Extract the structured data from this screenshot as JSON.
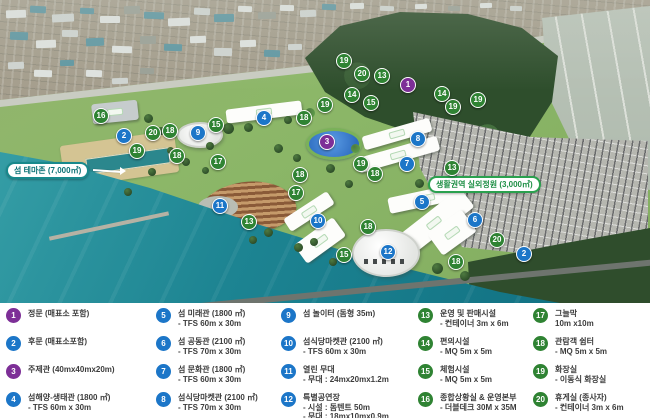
{
  "map": {
    "labels": {
      "theme_zone": "섬 테마존 (7,000㎡)",
      "outdoor_garden": "생활권역 실외정원 (3,000㎡)"
    },
    "marker_colors": {
      "blue": "#1c76c8",
      "green": "#2f8333",
      "purple": "#7d2f97"
    },
    "markers": [
      {
        "n": "16",
        "color": "green",
        "x": 100,
        "y": 115
      },
      {
        "n": "2",
        "color": "blue",
        "x": 123,
        "y": 135
      },
      {
        "n": "20",
        "color": "green",
        "x": 152,
        "y": 132
      },
      {
        "n": "18",
        "color": "green",
        "x": 169,
        "y": 130
      },
      {
        "n": "9",
        "color": "blue",
        "x": 197,
        "y": 132
      },
      {
        "n": "15",
        "color": "green",
        "x": 215,
        "y": 124
      },
      {
        "n": "4",
        "color": "blue",
        "x": 263,
        "y": 117
      },
      {
        "n": "18",
        "color": "green",
        "x": 303,
        "y": 117
      },
      {
        "n": "19",
        "color": "green",
        "x": 324,
        "y": 104
      },
      {
        "n": "19",
        "color": "green",
        "x": 136,
        "y": 150
      },
      {
        "n": "18",
        "color": "green",
        "x": 176,
        "y": 155
      },
      {
        "n": "17",
        "color": "green",
        "x": 217,
        "y": 161
      },
      {
        "n": "18",
        "color": "green",
        "x": 299,
        "y": 174
      },
      {
        "n": "17",
        "color": "green",
        "x": 295,
        "y": 192
      },
      {
        "n": "11",
        "color": "blue",
        "x": 219,
        "y": 205
      },
      {
        "n": "13",
        "color": "green",
        "x": 248,
        "y": 221
      },
      {
        "n": "10",
        "color": "blue",
        "x": 317,
        "y": 220
      },
      {
        "n": "19",
        "color": "green",
        "x": 343,
        "y": 60
      },
      {
        "n": "20",
        "color": "green",
        "x": 361,
        "y": 73
      },
      {
        "n": "13",
        "color": "green",
        "x": 381,
        "y": 75
      },
      {
        "n": "1",
        "color": "purple",
        "x": 407,
        "y": 84
      },
      {
        "n": "14",
        "color": "green",
        "x": 351,
        "y": 94
      },
      {
        "n": "15",
        "color": "green",
        "x": 370,
        "y": 102
      },
      {
        "n": "14",
        "color": "green",
        "x": 441,
        "y": 93
      },
      {
        "n": "19",
        "color": "green",
        "x": 452,
        "y": 106
      },
      {
        "n": "19",
        "color": "green",
        "x": 477,
        "y": 99
      },
      {
        "n": "3",
        "color": "purple",
        "x": 326,
        "y": 141
      },
      {
        "n": "8",
        "color": "blue",
        "x": 417,
        "y": 138
      },
      {
        "n": "7",
        "color": "blue",
        "x": 406,
        "y": 163
      },
      {
        "n": "19",
        "color": "green",
        "x": 360,
        "y": 163
      },
      {
        "n": "18",
        "color": "green",
        "x": 374,
        "y": 173
      },
      {
        "n": "13",
        "color": "green",
        "x": 451,
        "y": 167
      },
      {
        "n": "5",
        "color": "blue",
        "x": 421,
        "y": 201
      },
      {
        "n": "18",
        "color": "green",
        "x": 367,
        "y": 226
      },
      {
        "n": "6",
        "color": "blue",
        "x": 474,
        "y": 219
      },
      {
        "n": "20",
        "color": "green",
        "x": 496,
        "y": 239
      },
      {
        "n": "2",
        "color": "blue",
        "x": 523,
        "y": 253
      },
      {
        "n": "15",
        "color": "green",
        "x": 343,
        "y": 254
      },
      {
        "n": "12",
        "color": "blue",
        "x": 387,
        "y": 251
      },
      {
        "n": "18",
        "color": "green",
        "x": 455,
        "y": 261
      }
    ]
  },
  "legend": {
    "items": [
      {
        "n": "1",
        "color": "purple",
        "lines": [
          "정문 (매표소 포함)"
        ]
      },
      {
        "n": "2",
        "color": "blue",
        "lines": [
          "후문 (매표소포함)"
        ]
      },
      {
        "n": "3",
        "color": "purple",
        "lines": [
          "주제관 (40mx40mx20m)"
        ]
      },
      {
        "n": "4",
        "color": "blue",
        "lines": [
          "섬해양-생태관 (1800 ㎡)",
          "- TFS 60m x 30m"
        ]
      },
      {
        "n": "5",
        "color": "blue",
        "lines": [
          "섬 미래관 (1800 ㎡)",
          "- TFS 60m x 30m"
        ]
      },
      {
        "n": "6",
        "color": "blue",
        "lines": [
          "섬 공동관 (2100 ㎡)",
          "- TFS 70m x 30m"
        ]
      },
      {
        "n": "7",
        "color": "blue",
        "lines": [
          "섬 문화관 (1800 ㎡)",
          "- TFS 60m x 30m"
        ]
      },
      {
        "n": "8",
        "color": "blue",
        "lines": [
          "섬식당마켓관 (2100 ㎡)",
          "- TFS 70m x 30m"
        ]
      },
      {
        "n": "9",
        "color": "blue",
        "lines": [
          "섬 놀이터 (돔형 35m)"
        ]
      },
      {
        "n": "10",
        "color": "blue",
        "lines": [
          "섬식당마켓관 (2100 ㎡)",
          "- TFS 60m x 30m"
        ]
      },
      {
        "n": "11",
        "color": "blue",
        "lines": [
          "열린 무대",
          "- 무대 : 24mx20mx1.2m"
        ]
      },
      {
        "n": "12",
        "color": "blue",
        "lines": [
          "특별공연장",
          "- 시설 : 돔텐트 50m",
          "- 무대 : 18mx10mx0.9m"
        ]
      },
      {
        "n": "13",
        "color": "green",
        "lines": [
          "운영 및 판매시설",
          "- 컨테이너 3m x 6m"
        ]
      },
      {
        "n": "14",
        "color": "green",
        "lines": [
          "편의시설",
          "- MQ 5m x 5m"
        ]
      },
      {
        "n": "15",
        "color": "green",
        "lines": [
          "체험시설",
          "- MQ 5m x 5m"
        ]
      },
      {
        "n": "16",
        "color": "green",
        "lines": [
          "종합상황실 & 운영본부",
          "- 더블데크 30M x 35M"
        ]
      },
      {
        "n": "17",
        "color": "green",
        "lines": [
          "그늘막",
          "10m x10m"
        ]
      },
      {
        "n": "18",
        "color": "green",
        "lines": [
          "관람객 쉼터",
          "- MQ 5m x 5m"
        ]
      },
      {
        "n": "19",
        "color": "green",
        "lines": [
          "화장실",
          "- 이동식 화장실"
        ]
      },
      {
        "n": "20",
        "color": "green",
        "lines": [
          "휴게실 (종사자)",
          "- 컨테이너 3m x 6m"
        ]
      }
    ]
  }
}
